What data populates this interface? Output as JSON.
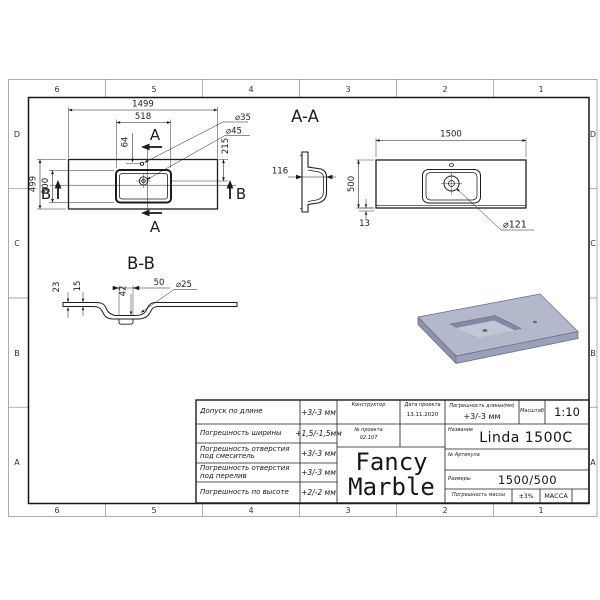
{
  "frame": {
    "zones_h": [
      "6",
      "5",
      "4",
      "3",
      "2",
      "1"
    ],
    "zones_v": [
      "D",
      "C",
      "B",
      "A"
    ]
  },
  "plan": {
    "d_length": "1499",
    "d_basin": "518",
    "d_64": "64",
    "d_215": "215",
    "d_hole35": "⌀35",
    "d_hole45": "⌀45",
    "d_depth": "499",
    "d_300": "300",
    "mark_a": "A",
    "mark_b": "B"
  },
  "aa": {
    "title": "A-A",
    "d_116": "116"
  },
  "front": {
    "d_1500": "1500",
    "d_500": "500",
    "d_13": "13",
    "d_drain": "⌀121"
  },
  "bb": {
    "title": "B-B",
    "d_23": "23",
    "d_15": "15",
    "d_42": "42",
    "d_50": "50",
    "d_25": "⌀25"
  },
  "title_block": {
    "tolerances": [
      {
        "label": "Допуск по длине",
        "value": "+3/-3 мм"
      },
      {
        "label": "Погрешность ширины",
        "value": "+1,5/-1,5мм"
      },
      {
        "label": "Погрешность отверстия под смеситель",
        "value": "+3/-3 мм"
      },
      {
        "label": "Погрешность отверстия под перелив",
        "value": "+3/-3 мм"
      },
      {
        "label": "Погрешность по высоте",
        "value": "+2/-2 мм"
      }
    ],
    "constructor_label": "Конструктор",
    "project_label": "№ проекта",
    "project_value": "02.107",
    "date_label": "Дата проекта",
    "date_value": "13.11.2020",
    "length_tol_label": "Погрешность длины(мм)",
    "length_tol_value": "+3/-3 мм",
    "scale_label": "Масштаб",
    "scale_value": "1:10",
    "name_label": "Название",
    "name_value": "Linda 1500C",
    "article_label": "№ Артикула",
    "size_label": "Размеры",
    "size_value": "1500/500",
    "mass_tol_label": "Погрешность массы",
    "mass_tol_value": "±3%",
    "mass_col_label": "МАССА",
    "logo_line1": "Fancy",
    "logo_line2": "Marble"
  },
  "colors": {
    "line": "#1c1c1c",
    "frame_light": "#8a8a8a",
    "render_top": "#b3b8cb",
    "render_front": "#9ba1b8",
    "render_side": "#8d93ac",
    "render_shadow": "#8289a3",
    "render_light": "#c2c6d5",
    "render_edge": "#646b8a"
  }
}
